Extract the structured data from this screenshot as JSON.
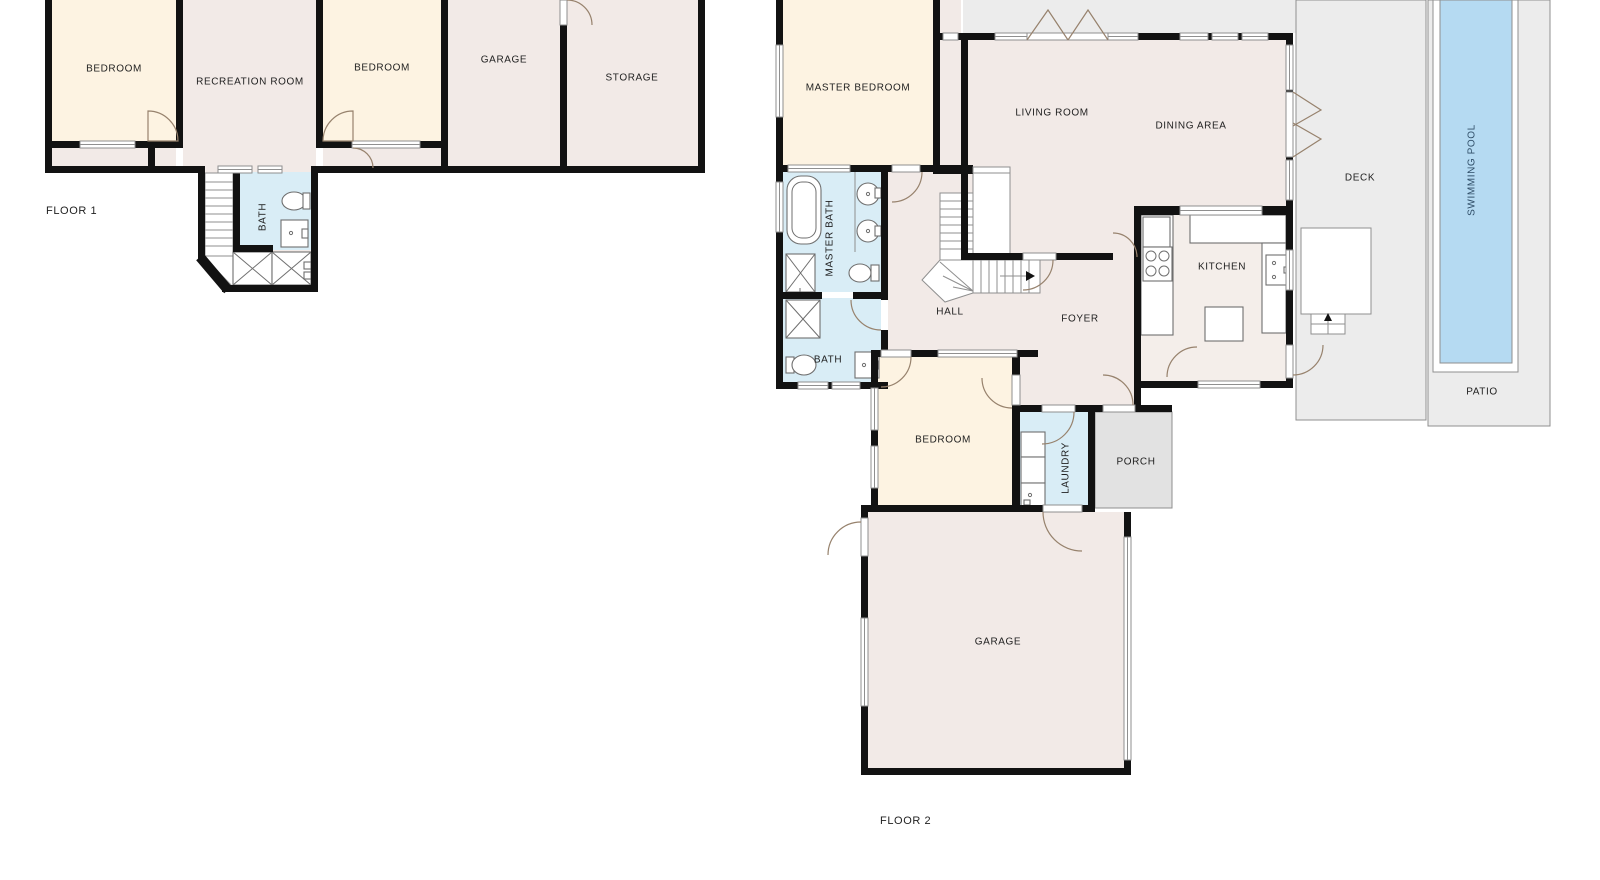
{
  "page": {
    "title": "House floor plans",
    "background": "#ffffff"
  },
  "palette": {
    "wall": "#121212",
    "room_warm": "#fdf3e2",
    "room_neutral": "#f2eae7",
    "room_wet": "#d9edf6",
    "kitchen": "#f4eeea",
    "outdoor": "#ececec",
    "porch": "#e2e2e2",
    "pool_water": "#b5daf2",
    "outline": "#8f8f8f",
    "fixline": "#6f6f6f",
    "door": "#97826d",
    "label": "#1f1f1f",
    "pool_label": "#2e4c66"
  },
  "floors": [
    {
      "label": "FLOOR 1",
      "rooms": [
        {
          "name": "bedroom-1",
          "label": "BEDROOM"
        },
        {
          "name": "recreation-room",
          "label": "RECREATION ROOM"
        },
        {
          "name": "bedroom-2",
          "label": "BEDROOM"
        },
        {
          "name": "garage",
          "label": "GARAGE"
        },
        {
          "name": "storage",
          "label": "STORAGE"
        },
        {
          "name": "bath",
          "label": "BATH"
        }
      ]
    },
    {
      "label": "FLOOR 2",
      "rooms": [
        {
          "name": "master-bedroom",
          "label": "MASTER BEDROOM"
        },
        {
          "name": "living-room",
          "label": "LIVING ROOM"
        },
        {
          "name": "dining-area",
          "label": "DINING AREA"
        },
        {
          "name": "deck",
          "label": "DECK"
        },
        {
          "name": "swimming-pool",
          "label": "SWIMMING POOL"
        },
        {
          "name": "patio",
          "label": "PATIO"
        },
        {
          "name": "master-bath",
          "label": "MASTER BATH"
        },
        {
          "name": "bath",
          "label": "BATH"
        },
        {
          "name": "hall",
          "label": "HALL"
        },
        {
          "name": "foyer",
          "label": "FOYER"
        },
        {
          "name": "kitchen",
          "label": "KITCHEN"
        },
        {
          "name": "bedroom",
          "label": "BEDROOM"
        },
        {
          "name": "laundry",
          "label": "LAUNDRY"
        },
        {
          "name": "porch",
          "label": "PORCH"
        },
        {
          "name": "garage",
          "label": "GARAGE"
        }
      ]
    }
  ]
}
